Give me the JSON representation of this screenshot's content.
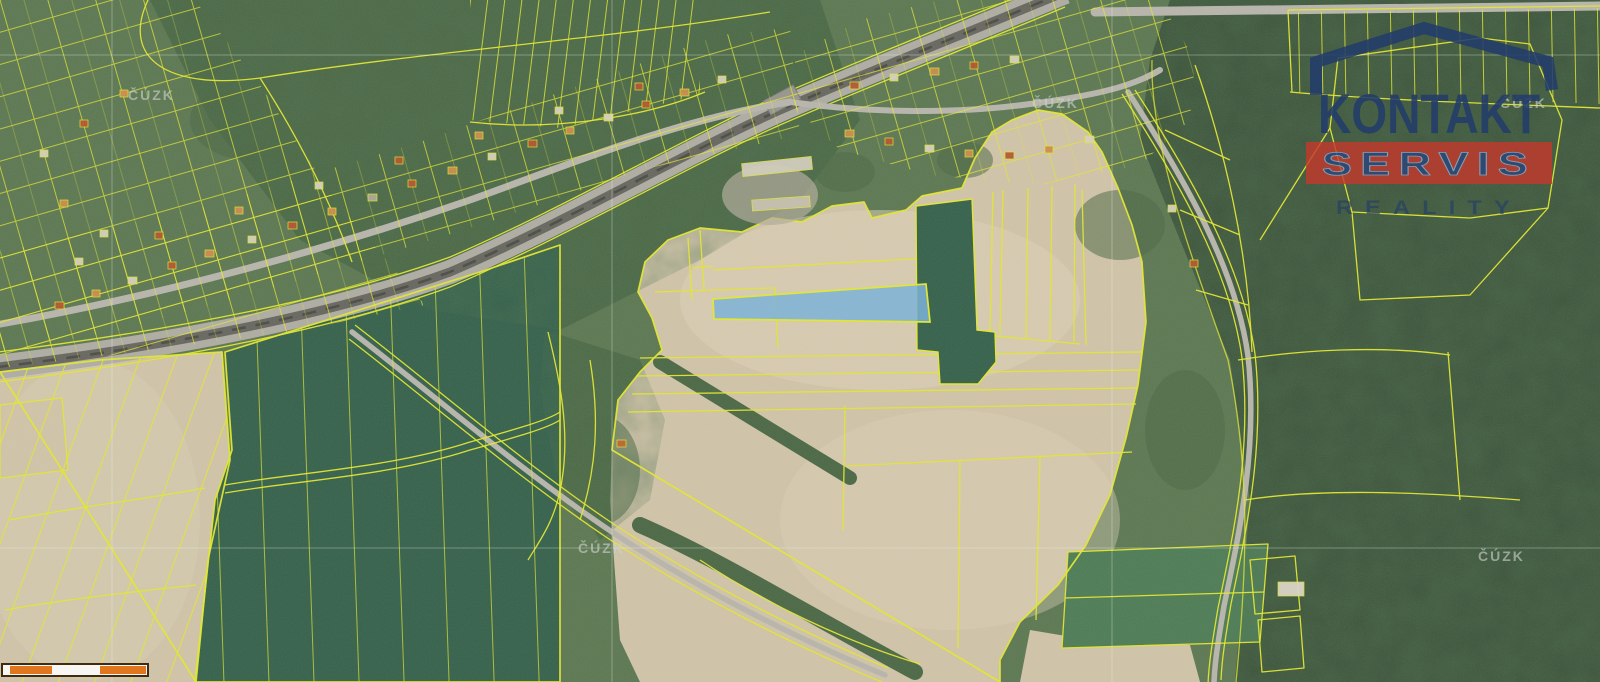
{
  "map": {
    "kind": "cadastral-orthophoto-map",
    "watermark_label": "ČÚZK"
  },
  "logo": {
    "title": "KONTAKT",
    "banner": "SERVIS",
    "subtitle": "REALITY"
  },
  "colors": {
    "base-green": "#5b7751",
    "forest-dark": "#3a5238",
    "forest-mid": "#4a6743",
    "field-beige": "#d2c5a9",
    "field-beige-light": "#ded3b9",
    "crop-green": "#33604a",
    "crop-green-light": "#4c7c54",
    "parcel-yellow": "#e6ea2d",
    "highlight-blue": "#79b3dc",
    "railway-grey": "#b0aea4",
    "railway-dark": "#66665e",
    "road-grey": "#b9b7ad",
    "logo-navy": "#233c6b",
    "logo-red": "#c4382b",
    "watermark-grey": "#ccd2cc",
    "scalebar-orange": "#e0761e",
    "scalebar-border": "#3f2a12",
    "scalebar-white": "#f8f6f2"
  }
}
